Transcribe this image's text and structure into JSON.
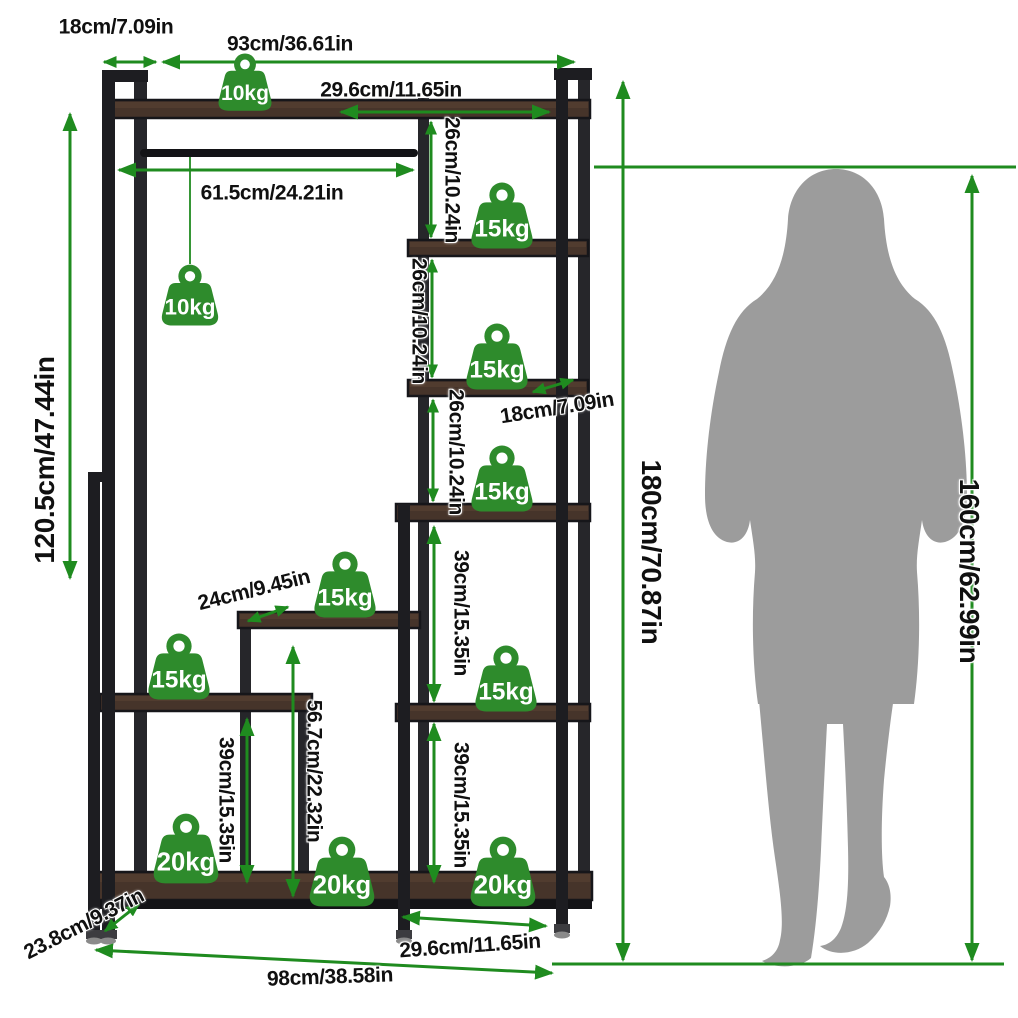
{
  "diagram": {
    "kind": "product-dimension-diagram",
    "subject": "freestanding garment rack with staggered storage shelves, shown with human figure for scale",
    "total_height": "180cm/70.87in",
    "total_width": "98cm/38.58in",
    "person_height": "160cm/62.99in"
  },
  "colors": {
    "accent_green": "#1f8b1f",
    "badge_green": "#2e8b2c",
    "wood_mid": "#46342a",
    "wood_light": "#5c4433",
    "frame_dark": "#1d1d21",
    "frame_mid": "#26262a",
    "silhouette_gray": "#9c9c9c",
    "label_text": "#101010",
    "background": "#ffffff"
  },
  "dimension_labels": [
    {
      "id": "top-depth",
      "text": "18cm/7.09in",
      "x": 116,
      "y": 27,
      "rot": 0,
      "size": "m"
    },
    {
      "id": "top-width",
      "text": "93cm/36.61in",
      "x": 290,
      "y": 44,
      "rot": 0,
      "size": "m"
    },
    {
      "id": "top-shelf-width",
      "text": "29.6cm/11.65in",
      "x": 391,
      "y": 90,
      "rot": 0,
      "size": "m"
    },
    {
      "id": "rod-width",
      "text": "61.5cm/24.21in",
      "x": 272,
      "y": 193,
      "rot": 0,
      "size": "m"
    },
    {
      "id": "left-section-height",
      "text": "120.5cm/47.44in",
      "x": 45,
      "y": 460,
      "rot": -90,
      "size": "l"
    },
    {
      "id": "cubby-height-1",
      "text": "26cm/10.24in",
      "x": 452,
      "y": 180,
      "rot": 90,
      "size": "m"
    },
    {
      "id": "cubby-height-2",
      "text": "26cm/10.24in",
      "x": 419,
      "y": 321,
      "rot": 90,
      "size": "m"
    },
    {
      "id": "cubby-height-3",
      "text": "26cm/10.24in",
      "x": 456,
      "y": 452,
      "rot": 90,
      "size": "m"
    },
    {
      "id": "shelf-depth",
      "text": "18cm/7.09in",
      "x": 557,
      "y": 408,
      "rot": -9,
      "size": "m"
    },
    {
      "id": "total-height",
      "text": "180cm/70.87in",
      "x": 651,
      "y": 552,
      "rot": 90,
      "size": "l"
    },
    {
      "id": "person-height",
      "text": "160cm/62.99in",
      "x": 969,
      "y": 571,
      "rot": 90,
      "size": "l"
    },
    {
      "id": "small-shelf-width",
      "text": "24cm/9.45in",
      "x": 254,
      "y": 590,
      "rot": -14,
      "size": "m"
    },
    {
      "id": "right-upper-height",
      "text": "39cm/15.35in",
      "x": 461,
      "y": 613,
      "rot": 90,
      "size": "m"
    },
    {
      "id": "right-lower-height",
      "text": "39cm/15.35in",
      "x": 461,
      "y": 805,
      "rot": 90,
      "size": "m"
    },
    {
      "id": "left-lower-height",
      "text": "39cm/15.35in",
      "x": 226,
      "y": 800,
      "rot": 90,
      "size": "m"
    },
    {
      "id": "mid-column-height",
      "text": "56.7cm/22.32in",
      "x": 314,
      "y": 771,
      "rot": 90,
      "size": "m"
    },
    {
      "id": "base-depth",
      "text": "23.8cm/9.37in",
      "x": 84,
      "y": 924,
      "rot": -27,
      "size": "m"
    },
    {
      "id": "base-shelf-width",
      "text": "29.6cm/11.65in",
      "x": 470,
      "y": 946,
      "rot": -4,
      "size": "m"
    },
    {
      "id": "total-width",
      "text": "98cm/38.58in",
      "x": 330,
      "y": 977,
      "rot": -2,
      "size": "m"
    }
  ],
  "weight_badges": [
    {
      "id": "top-shelf",
      "label": "10kg",
      "x": 245,
      "y": 112,
      "size": 64
    },
    {
      "id": "hanging-rod",
      "label": "10kg",
      "x": 190,
      "y": 327,
      "size": 68
    },
    {
      "id": "right-shelf-1",
      "label": "15kg",
      "x": 502,
      "y": 250,
      "size": 74
    },
    {
      "id": "right-shelf-2",
      "label": "15kg",
      "x": 497,
      "y": 391,
      "size": 74
    },
    {
      "id": "right-shelf-3",
      "label": "15kg",
      "x": 502,
      "y": 513,
      "size": 74
    },
    {
      "id": "middle-shelf",
      "label": "15kg",
      "x": 345,
      "y": 619,
      "size": 74
    },
    {
      "id": "left-shelf",
      "label": "15kg",
      "x": 179,
      "y": 701,
      "size": 74
    },
    {
      "id": "right-shelf-4",
      "label": "15kg",
      "x": 506,
      "y": 713,
      "size": 74
    },
    {
      "id": "base-left",
      "label": "20kg",
      "x": 186,
      "y": 885,
      "size": 78
    },
    {
      "id": "base-center",
      "label": "20kg",
      "x": 342,
      "y": 908,
      "size": 78
    },
    {
      "id": "base-right",
      "label": "20kg",
      "x": 503,
      "y": 908,
      "size": 78
    }
  ]
}
